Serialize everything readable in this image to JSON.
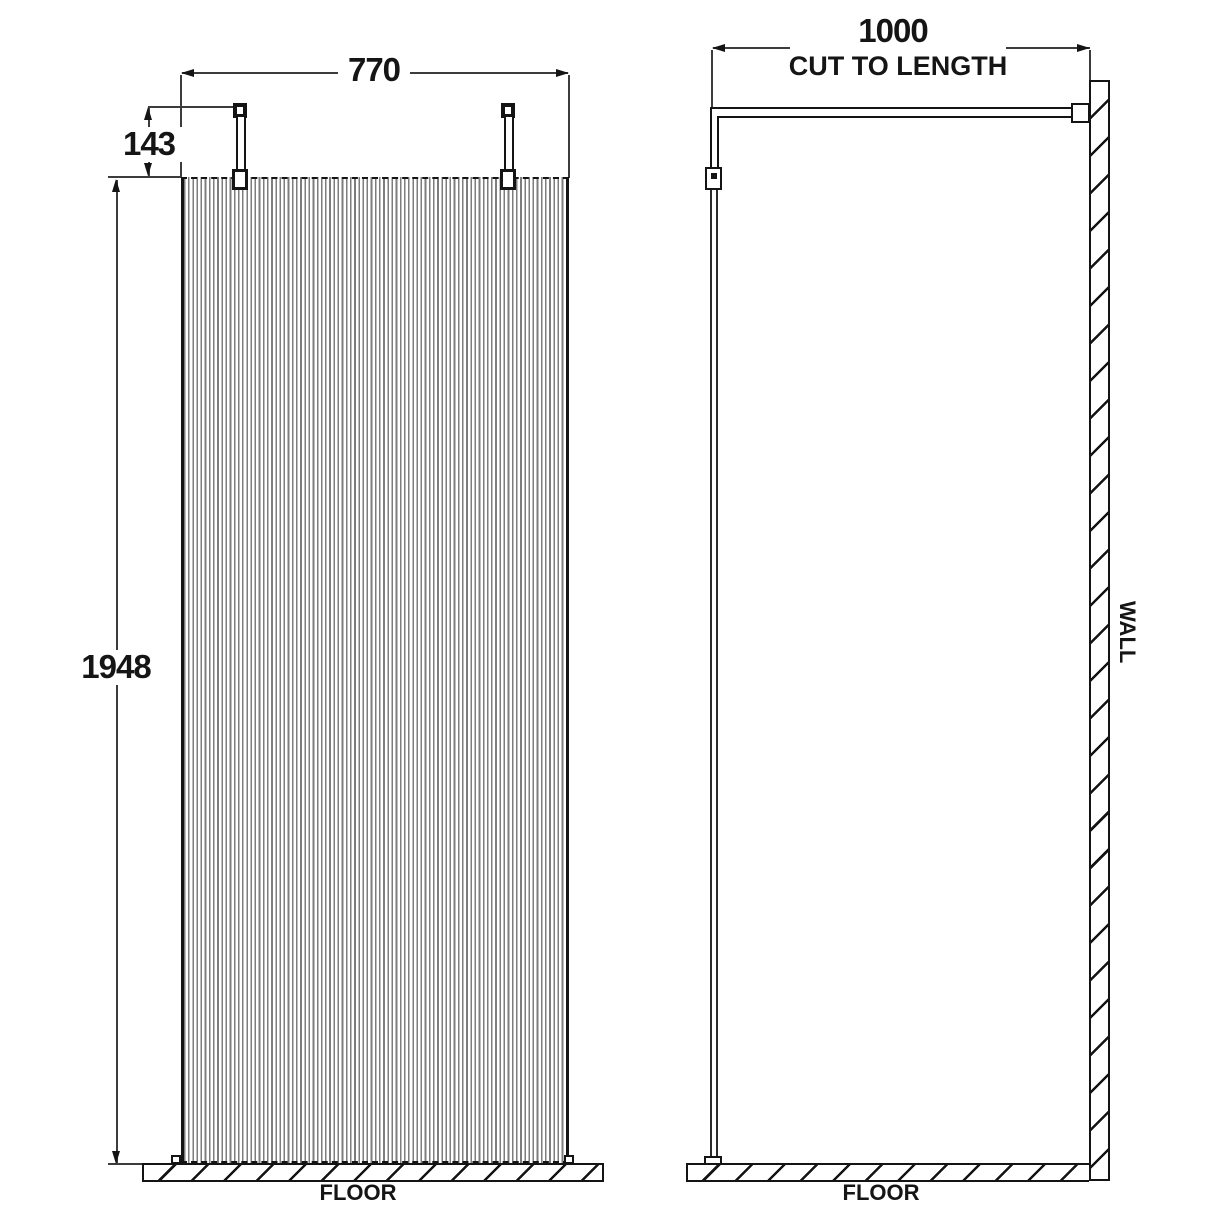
{
  "drawing": {
    "front_view": {
      "width_dim": "770",
      "rod_height_dim": "143",
      "panel_height_dim": "1948",
      "floor_label": "FLOOR"
    },
    "side_view": {
      "depth_dim": "1000",
      "depth_note": "CUT TO LENGTH",
      "wall_label": "WALL",
      "floor_label": "FLOOR"
    },
    "colors": {
      "line": "#141414",
      "flute_line": "#7d7d7d",
      "background": "#ffffff"
    }
  }
}
